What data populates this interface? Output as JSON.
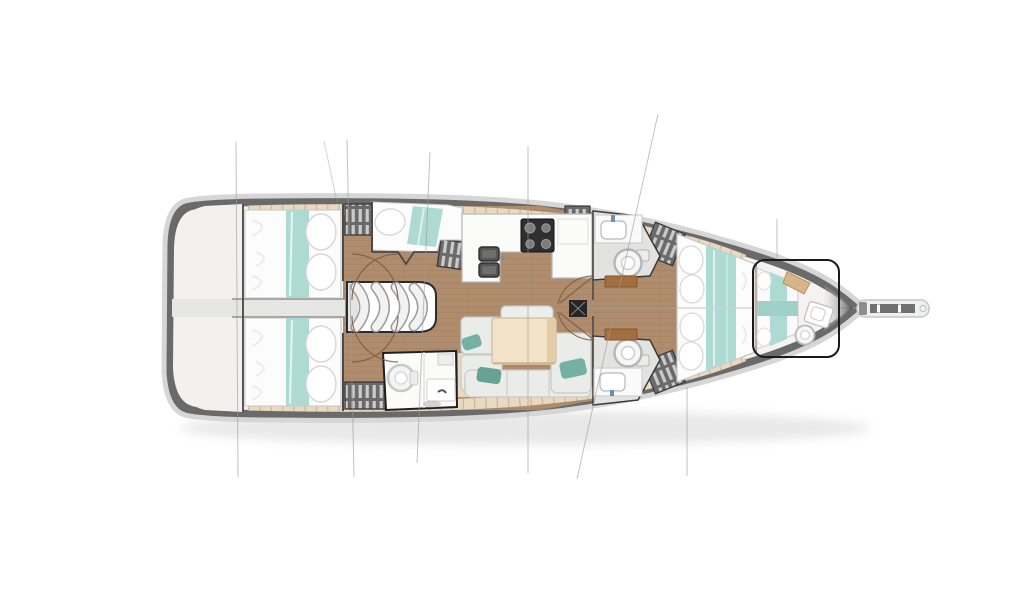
{
  "diagram": {
    "type": "yacht-interior-deck-plan",
    "orientation": "bow-right",
    "visible_text": [],
    "title": "Sailing yacht interior layout plan (top view)",
    "colors": {
      "background": "#ffffff",
      "hull_band": "#6a6a6a",
      "hull_rim": "#d6d6d6",
      "inner_deck": "#f4f3f1",
      "stern_deck": "#f2f1ef",
      "teak_sidedeck": "#e9d9c0",
      "teak_tick": "#c9b697",
      "wood_floor": "#b08c6e",
      "plank_line": "#9e7b5b",
      "bedding_white": "#fcfcfc",
      "bedding_teal": "#aedad4",
      "locker_dark": "#6a6a6a",
      "locker_slat": "#dcdcdc",
      "galley_counter": "#fbfbfa",
      "stove_black": "#2f2f2f",
      "sink_gray": "#5a5a5a",
      "head_floor": "#e2e2e1",
      "fixture_white": "#f6f6f6",
      "sofa_gray": "#eaece9",
      "throw_pillow_teal": "#74b0a4",
      "table_wood": "#f2e2c8",
      "trim_wood": "#a46f3f",
      "mast_black": "#262626",
      "door_arc_brown": "#7d5a3f",
      "rigging_gray": "#9a9a9a"
    },
    "regions": {
      "hull": "Hull and deck outline with dark gunwale band",
      "stern_deck": "Aft deck / transom platform",
      "engine_compartment": "Engine compartment passage between aft cabins",
      "aft_cabin_port": "Aft cabin (top) with double berth, teal runner and pillows",
      "aft_cabin_starboard": "Aft cabin (bottom) with double berth, teal runner and pillows",
      "companionway": "Companionway with four curved steps",
      "mid_berth": "Amidships berth (top) beside companionway",
      "galley": "U-shaped galley with stove and twin sinks",
      "mid_head": "Amidships bathroom with toilet and washbasin",
      "salon": "Saloon with settee, teal throw pillows and wooden table",
      "mast": "Mast step on centerline",
      "head_fwd_port": "Forward head (top) with washbasin and toilet",
      "head_fwd_starboard": "Forward head (bottom) with toilet and washbasin",
      "owner_cabin": "Forward owner's cabin with island double berth",
      "forepeak": "Forepeak cabin with berth, shelf, washbasin and toilet",
      "bowsprit": "Bow fitting with anchor roller",
      "rigging": "Standing rigging reference lines",
      "lockers": "Slatted wardrobe and locker units",
      "door_arcs": "Door swing arcs",
      "centerline": "Fore-aft centerline"
    }
  }
}
